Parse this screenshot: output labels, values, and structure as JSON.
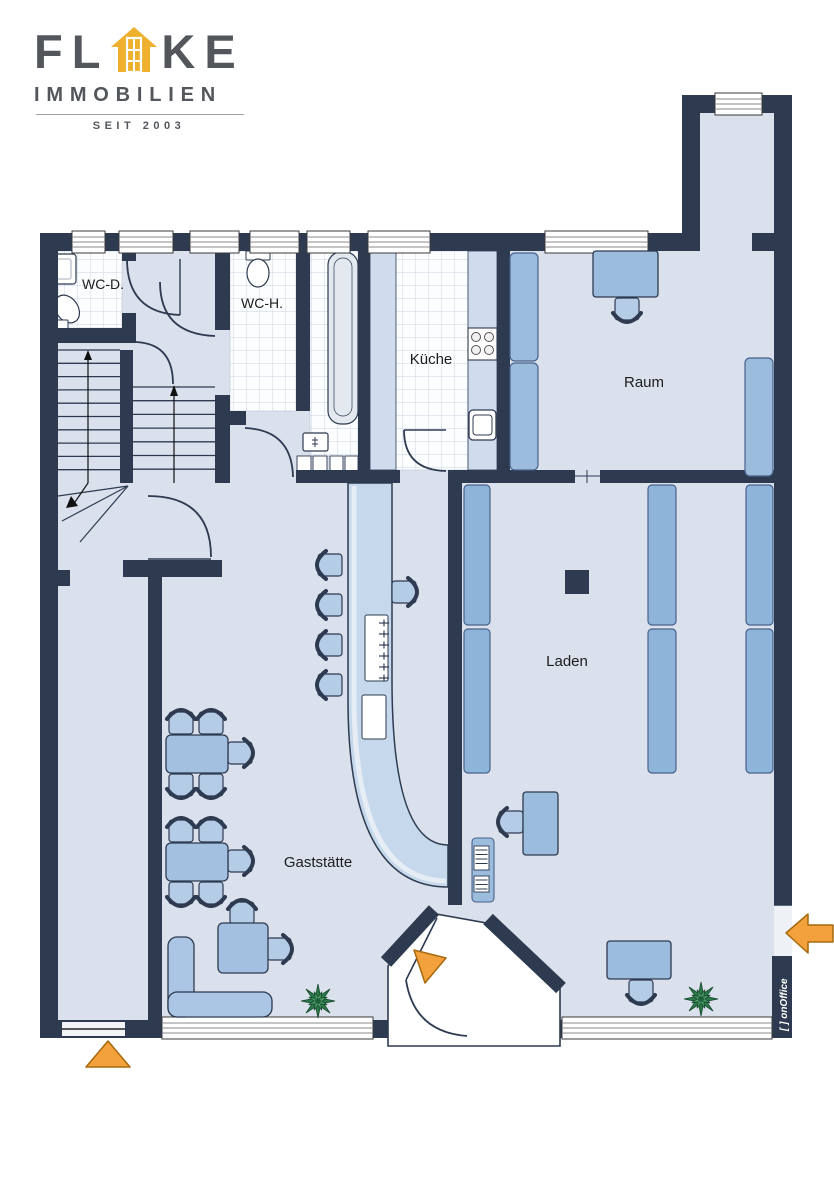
{
  "logo": {
    "brand_part1": "FL",
    "brand_part2": "KE",
    "subtitle": "IMMOBILIEN",
    "since": "SEIT 2003"
  },
  "rooms": {
    "wc_d": "WC-D.",
    "wc_h": "WC-H.",
    "kueche": "Küche",
    "raum": "Raum",
    "laden": "Laden",
    "gaststaette": "Gaststätte"
  },
  "watermark": "[ ] onOffice",
  "icons": {
    "logo_house": "house-icon",
    "entrance_markers": "orange-arrow-icon",
    "plants": "plant-icon",
    "stairs": "stair-direction-arrow"
  },
  "colors": {
    "wall": "#2d3a50",
    "floor": "#dae1ec",
    "tile_bg": "#fcfdfe",
    "tile_line": "#c6d2e0",
    "furniture": "#b5cce6",
    "furniture_mid": "#9cbcdd",
    "shelf": "#8fb4d9",
    "counter": "#c6d8ec",
    "counter_light": "#e7edf5",
    "fixture": "#e4e9f0",
    "orange": "#f2a13c",
    "orange_dark": "#a8690f",
    "green": "#2c7a4b",
    "green_dark": "#16492c",
    "logo_gold": "#efb02e",
    "logo_gray": "#53575c",
    "label": "#1c1c1c"
  }
}
